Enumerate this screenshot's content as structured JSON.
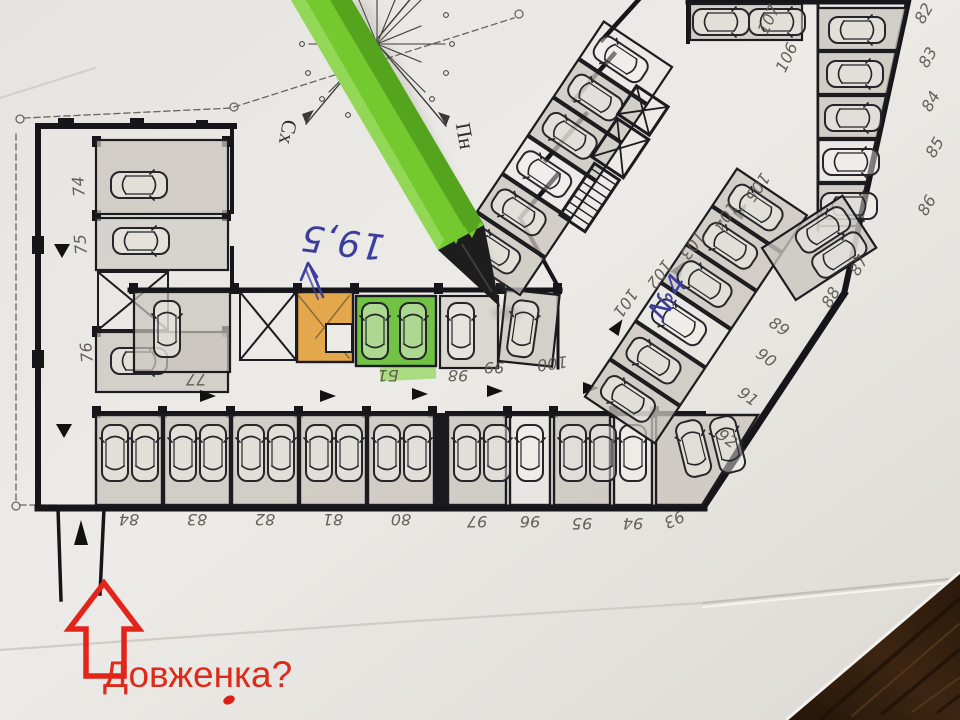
{
  "scene": {
    "description": "Photo of an underground parking floor plan on paper with a green pencil",
    "paper_color": "#eae8e4",
    "wood_color": "#33200f"
  },
  "compass": {
    "east_label": "Сх",
    "north_label": "Пн"
  },
  "notes": {
    "area": "19,5",
    "spot": "№4",
    "street": "Довженка?",
    "ink_blue": "#3c3e9e",
    "ink_red": "#de2417"
  },
  "pencil": {
    "body_color": "#74c92f",
    "tip_color": "#1d1d1d"
  },
  "highlights": {
    "orange": "#e29c30",
    "green": "#5abb28"
  },
  "labels": {
    "left_wing": [
      "74",
      "75",
      "76"
    ],
    "middle_row": [
      "77",
      "Б1",
      "98",
      "99",
      "100"
    ],
    "bottom_left": [
      "84",
      "83",
      "82",
      "81",
      "80"
    ],
    "bottom_right": [
      "97",
      "96",
      "95",
      "94",
      "93"
    ],
    "aisle_diagonal": [
      "101",
      "102",
      "103",
      "104",
      "105"
    ],
    "top_right": [
      "107",
      "106"
    ],
    "right_edge": [
      "82",
      "83",
      "84",
      "85",
      "86",
      "87",
      "88"
    ],
    "lower_diagonal": [
      "89",
      "90",
      "91",
      "92"
    ]
  }
}
